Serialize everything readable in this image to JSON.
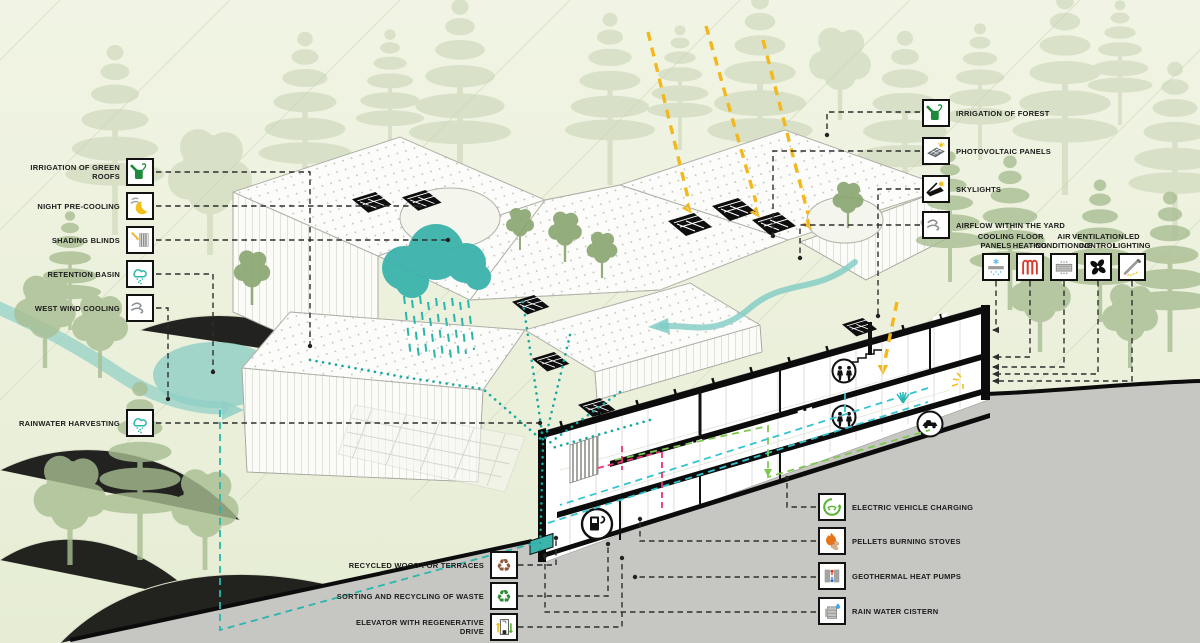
{
  "colors": {
    "background": "#edf1df",
    "teal_water": "#2ab5ad",
    "teal_soft": "#8fcfc6",
    "sun_yellow": "#f2b81e",
    "leader_black": "#2e2e2e",
    "green_line": "#7ec850",
    "cyan_line": "#35c4cf",
    "pink_line": "#e8346d",
    "road_gray": "#c6c6c3",
    "tree_green": "#8fae77"
  },
  "legend_left": {
    "items": [
      {
        "label": "IRRIGATION OF GREEN ROOFS",
        "icon": "watering-can"
      },
      {
        "label": "NIGHT PRE-COOLING",
        "icon": "moon-wind"
      },
      {
        "label": "SHADING BLINDS",
        "icon": "blinds"
      },
      {
        "label": "RETENTION BASIN",
        "icon": "rain-cloud"
      },
      {
        "label": "WEST WIND COOLING",
        "icon": "wind"
      },
      {
        "label": "RAINWATER HARVESTING",
        "icon": "rain-cloud"
      }
    ]
  },
  "legend_right": {
    "items": [
      {
        "label": "IRRIGATION OF FOREST",
        "icon": "watering-can"
      },
      {
        "label": "PHOTOVOLTAIC PANELS",
        "icon": "pv-panel"
      },
      {
        "label": "SKYLIGHTS",
        "icon": "skylight"
      },
      {
        "label": "AIRFLOW WITHIN THE YARD",
        "icon": "wind"
      }
    ]
  },
  "systems_row": {
    "items": [
      {
        "label": "COOLING\nPANELS",
        "icon": "cooling-panel"
      },
      {
        "label": "FLOOR\nHEATING",
        "icon": "floor-heating"
      },
      {
        "label": "AIR\nCONDITIONING",
        "icon": "air-conditioning"
      },
      {
        "label": "VENTILATION\nCONTROL",
        "icon": "fan"
      },
      {
        "label": "LED\nLIGHTING",
        "icon": "led"
      }
    ]
  },
  "legend_bottom_right": {
    "items": [
      {
        "label": "ELECTRIC VEHICLE CHARGING",
        "icon": "ev-charging"
      },
      {
        "label": "PELLETS BURNING STOVES",
        "icon": "pellets"
      },
      {
        "label": "GEOTHERMAL HEAT PUMPS",
        "icon": "heat-pump"
      },
      {
        "label": "RAIN WATER CISTERN",
        "icon": "cistern"
      }
    ]
  },
  "legend_bottom_left": {
    "items": [
      {
        "label": "RECYCLED WOOD FOR TERRACES",
        "icon": "recycle-brown"
      },
      {
        "label": "SORTING AND RECYCLING OF WASTE",
        "icon": "recycle-green"
      },
      {
        "label": "ELEVATOR WITH REGENERATIVE DRIVE",
        "icon": "elevator"
      }
    ]
  }
}
